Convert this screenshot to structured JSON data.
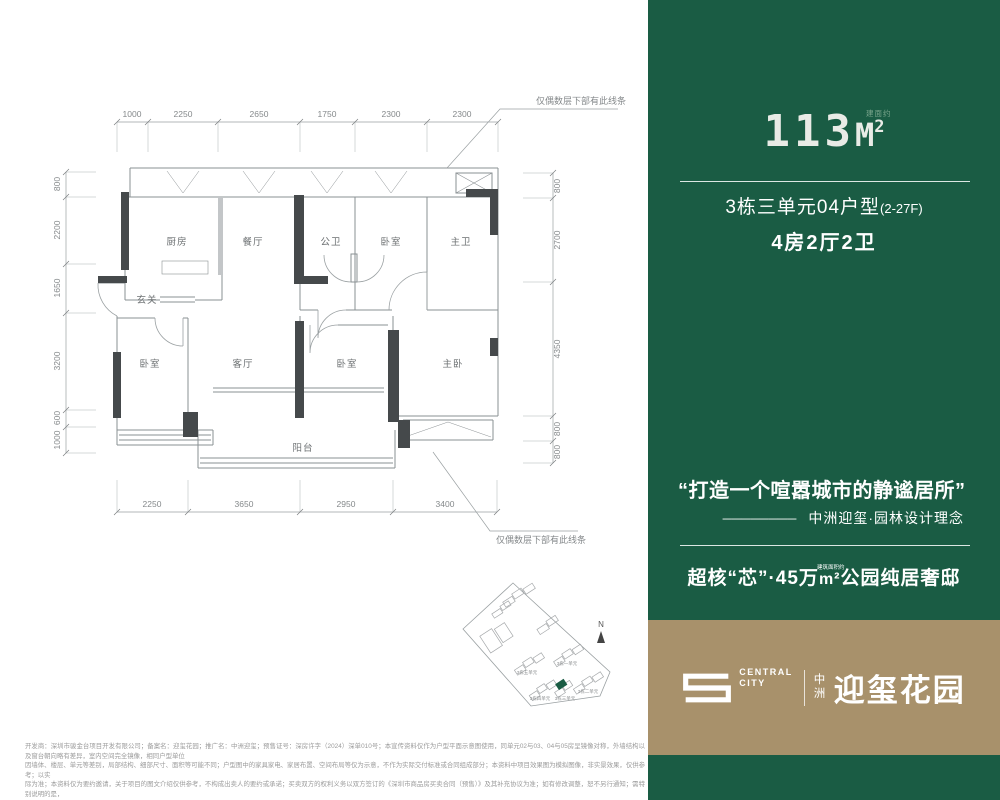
{
  "right": {
    "area": {
      "num": "113",
      "unit": "M",
      "sup": "2",
      "note": "建面约"
    },
    "unit_name": "3栋三单元04户型",
    "unit_floors": "(2-27F)",
    "layout": "4房2厅2卫",
    "quote": "“打造一个喧嚣城市的静谧居所”",
    "attrib_dash": "────────",
    "attrib_text": "中洲迎玺·园林设计理念",
    "slogan_pre": "超核“芯”·45万",
    "slogan_unit": "m²",
    "slogan_note": "建筑面积约",
    "slogan_post": "公园纯居奢邸",
    "colors": {
      "green": "#1A5C44",
      "tan": "#A8916B",
      "area_text": "#E9EBE6"
    }
  },
  "logo": {
    "en_line1": "CENTRAL",
    "en_line2": "CITY",
    "cn_small": "中洲",
    "cn_large": "迎玺花园"
  },
  "plan": {
    "rooms": [
      "厨房",
      "餐厅",
      "公卫",
      "卧室",
      "主卫",
      "玄关",
      "卧室",
      "客厅",
      "卧室",
      "主卧",
      "阳台"
    ],
    "dims_top": [
      "1000",
      "2250",
      "2650",
      "1750",
      "2300",
      "2300"
    ],
    "dims_left": [
      "800",
      "2200",
      "1650",
      "3200",
      "600",
      "1000"
    ],
    "dims_right": [
      "800",
      "2700",
      "4350",
      "800",
      "800"
    ],
    "dims_bottom": [
      "2250",
      "3650",
      "2950",
      "3400"
    ],
    "note_top": "仅偶数层下部有此线条",
    "note_bottom": "仅偶数层下部有此线条"
  },
  "site_map": {
    "north": "N",
    "labels": [
      "3栋一单元",
      "3栋五单元",
      "3栋二单元",
      "3栋四单元",
      "3栋三单元"
    ]
  },
  "fine_print": {
    "lines": [
      "开发商：深圳市骏金台项目开发有限公司；备案名：迎玺花园；推广名：中洲迎玺；预售证号：深房许字（2024）深单010号；本宣传资料仅作为户型平面示意图使用，同单元02与03、04与05房呈镜像对称，外墙结构以及窗台朝向略有差异，室内空间完全镜像，相同户型单位",
      "因墙体、楼层、单元等差别，局部结构、细部尺寸、面积等可能不同；户型图中的家具家电、家居布置、空间布局等仅为示意，不作为实际交付标准或合同组成部分；本资料中项目效果图为模拟图像，非实景效果，仅供参考；以实",
      "际为准；本资料仅为要约邀请，关于项目的图文介绍仅供参考，不构成出卖人的要约或承诺；买卖双方的权利义务以双方签订的《深圳市商品房买卖合同（预售）》及其补充协议为准；如有修改调整，恕不另行通知；需特别说明的是，",
      "政府规划的“城市超核”，说法来源于深圳市规划和自然资源局公众号《深圳北站枢纽地区城市设计国际咨询有关概念深化成果重磅出炉》，发布日期2021年12月24日；制作时间：2025年01月。"
    ]
  }
}
